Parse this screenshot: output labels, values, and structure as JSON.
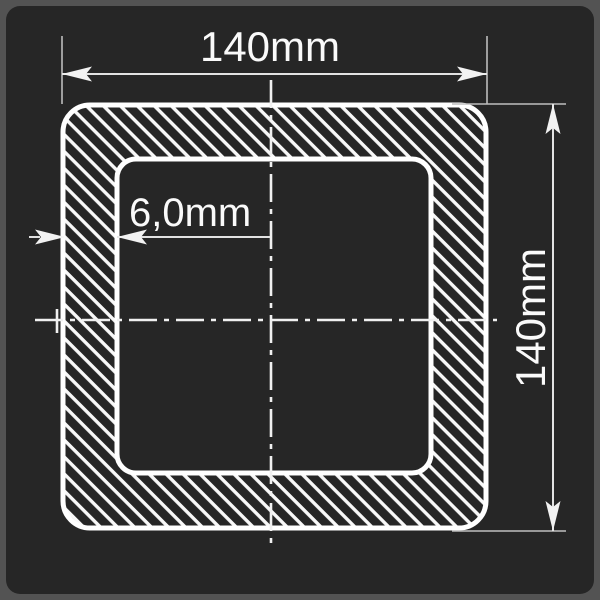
{
  "drawing": {
    "shape": "square-hollow-section-cross-section",
    "outer_width": {
      "label": "140mm"
    },
    "outer_height": {
      "label": "140mm"
    },
    "wall_thickness": {
      "label": "6,0mm"
    }
  },
  "colors": {
    "page_bg": "#535353",
    "panel_bg": "#262626",
    "profile_stroke": "#ffffff",
    "hatch": "#f8f8f8",
    "dimension_line": "#e2e2e2",
    "extension_line": "#bdbdbd",
    "centerline": "#f0f0f0",
    "arrow_fill": "#f2f2f2",
    "text": "#fafafa"
  }
}
